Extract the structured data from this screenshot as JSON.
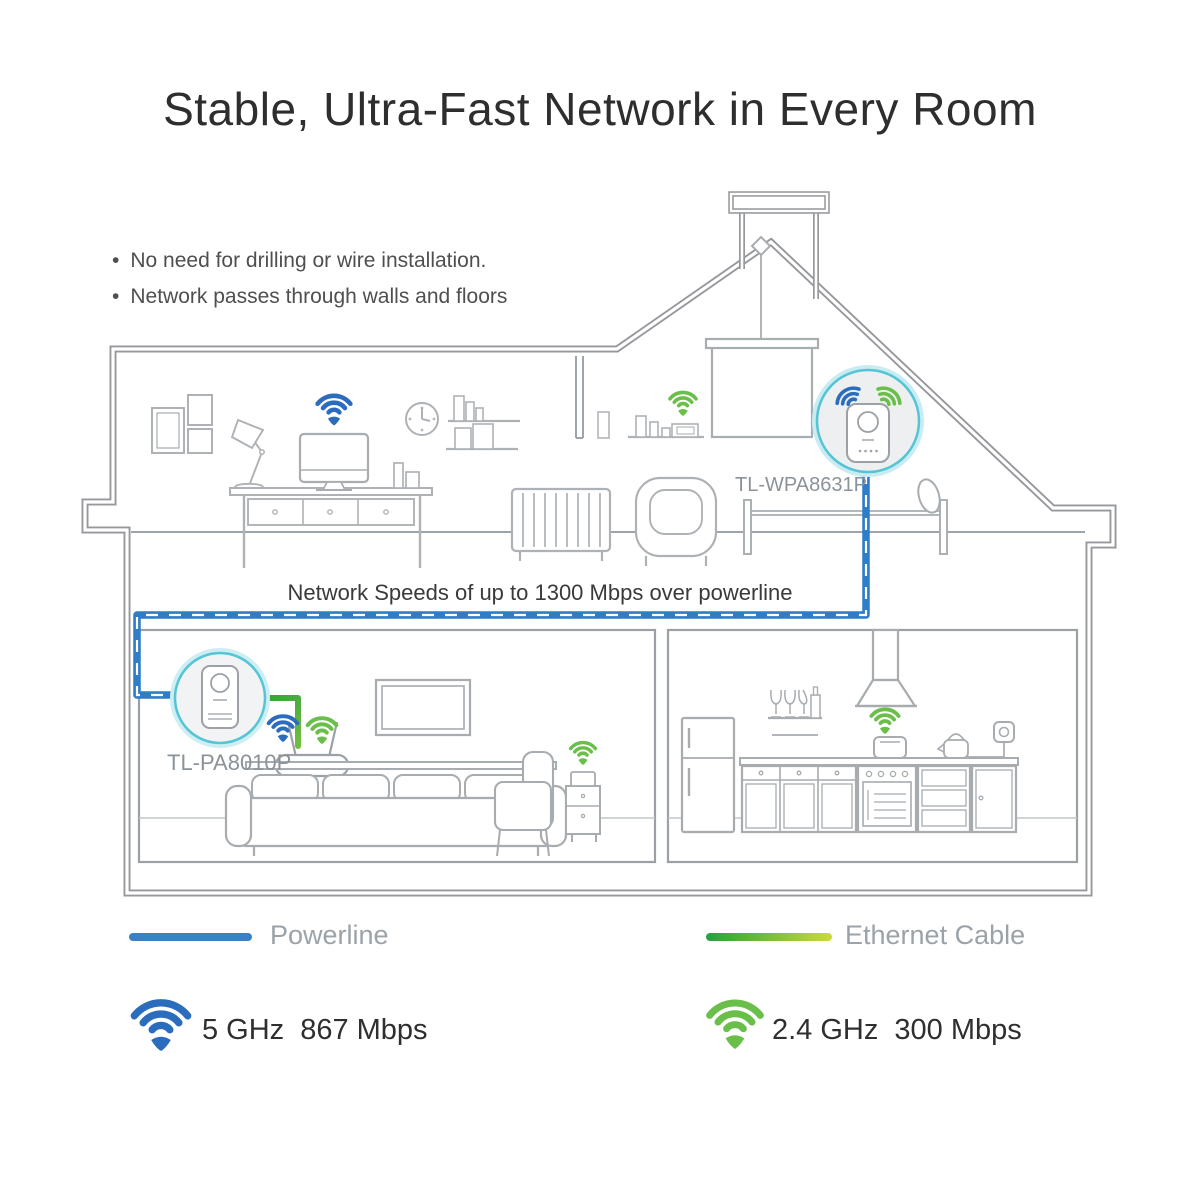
{
  "title": "Stable, Ultra-Fast Network in Every Room",
  "bullets": {
    "item1": "No need for drilling or wire installation.",
    "item2": "Network passes through walls and floors"
  },
  "house": {
    "caption": "Network Speeds of up to 1300 Mbps over powerline",
    "adapter_attic": {
      "model": "TL-WPA8631P"
    },
    "adapter_living": {
      "model": "TL-PA8010P"
    }
  },
  "legend": {
    "powerline_label": "Powerline",
    "ethernet_label": "Ethernet Cable"
  },
  "wifi": {
    "band5": {
      "band": "5 GHz",
      "speed": "867 Mbps"
    },
    "band24": {
      "band": "2.4 GHz",
      "speed": "300 Mbps"
    }
  },
  "colors": {
    "powerline_blue": "#2f7cc8",
    "ethernet_green_start": "#2ba13f",
    "ethernet_green_end": "#c6d93a",
    "wifi_blue": "#2b6cbd",
    "wifi_green": "#6abf4b",
    "adapter_ring_cyan": "#54c4d6",
    "house_outline_gray": "#96989c"
  }
}
